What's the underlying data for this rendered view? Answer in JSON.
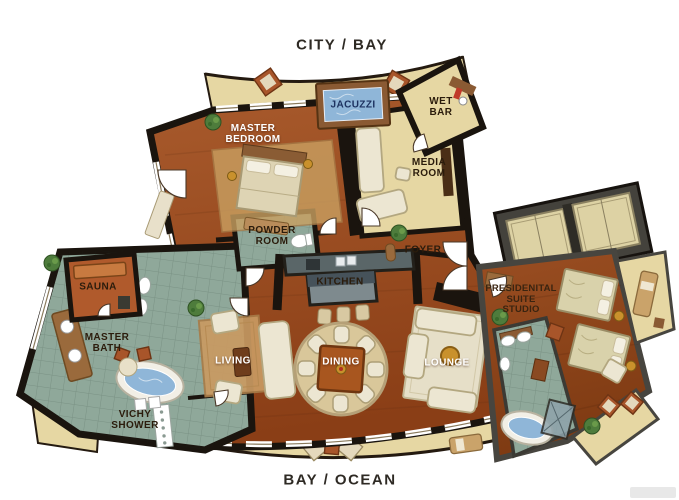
{
  "titles": {
    "top": "CITY / BAY",
    "bottom": "BAY / OCEAN"
  },
  "rooms": {
    "jacuzzi": "JACUZZI",
    "wet_bar": "WET\nBAR",
    "master_bedroom": "MASTER\nBEDROOM",
    "media_room": "MEDIA\nROOM",
    "powder_room": "POWDER\nROOM",
    "foyer": "FOYER",
    "kitchen": "KITCHEN",
    "sauna": "SAUNA",
    "master_bath": "MASTER\nBATH",
    "living": "LIVING",
    "dining": "DINING",
    "lounge": "LOUNGE",
    "vichy_shower": "VICHY\nSHOWER",
    "presidential_suite_studio": "PRESIDENITAL\nSUITE\nSTUDIO"
  },
  "colors": {
    "wood": "#9a4a1f",
    "wood_dark": "#823a12",
    "tile": "#8fa89a",
    "balcony": "#e6d7a3",
    "wall": "#1a140e",
    "wall_gray": "#47453f",
    "water": "#8fb6d8",
    "cream": "#ece6d2",
    "rug": "#d9c79a",
    "accent_chair": "#a8552a",
    "gold": "#c9912c",
    "plant": "#4e7c3c",
    "label_dark": "#2b1c0c",
    "label_light": "#ffffff"
  }
}
